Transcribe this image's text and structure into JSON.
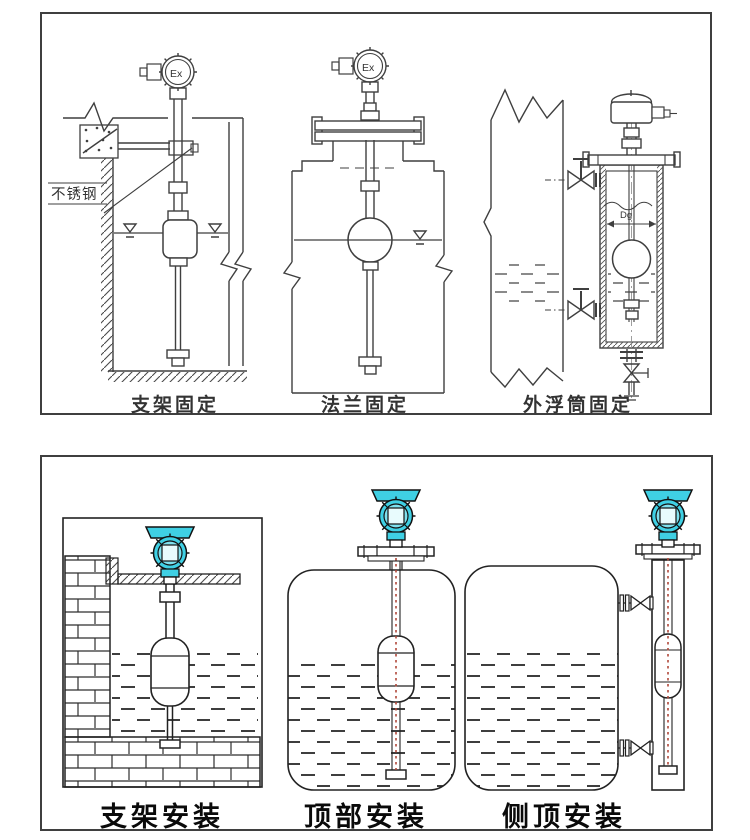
{
  "top": {
    "figures": [
      {
        "caption": "支架固定",
        "device_label": "Ex",
        "material_label": "不锈钢"
      },
      {
        "caption": "法兰固定",
        "device_label": "Ex"
      },
      {
        "caption": "外浮筒固定",
        "dimension_label": "Dg"
      }
    ]
  },
  "bottom": {
    "figures": [
      {
        "caption": "支架安装"
      },
      {
        "caption": "顶部安装"
      },
      {
        "caption": "侧顶安装"
      }
    ]
  },
  "colors": {
    "line": "#3f3f3f",
    "transmitter_cyan": "#3fd0e4",
    "float_rod_red": "#b0483a",
    "caption_dark": "#111111"
  }
}
